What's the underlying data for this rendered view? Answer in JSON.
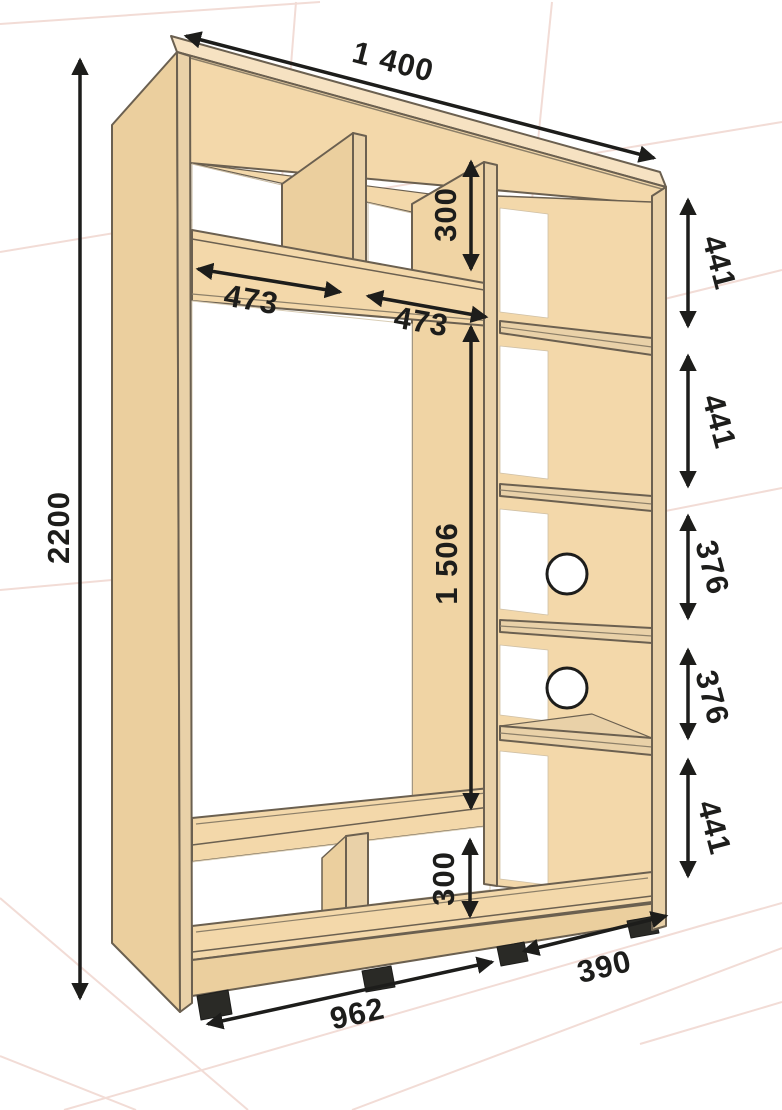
{
  "diagram": {
    "title": "Wardrobe carcass dimension drawing",
    "view": "perspective front view",
    "units": "mm",
    "colors": {
      "panel_face": "#f3d8aa",
      "panel_side": "#ebcf9e",
      "panel_edge": "#e9d1a8",
      "outline": "#6b6050",
      "dimension_ink": "#1d1d1b",
      "background": "#ffffff",
      "grid_line": "#f2dcd6"
    },
    "dimensions": {
      "overall_width": "1 400",
      "overall_height": "2200",
      "top_section_left_width": "473",
      "top_section_right_width": "473",
      "top_section_height": "300",
      "hanging_section_height": "1 506",
      "bottom_section_height": "300",
      "right_column_space_1": "441",
      "right_column_space_2": "441",
      "right_column_space_3": "376",
      "right_column_space_4": "376",
      "right_column_space_5": "441",
      "left_section_width": "962",
      "side_depth": "390"
    },
    "features": {
      "rod_holes_count": 2,
      "feet_count": 4,
      "right_column_shelves": 4
    }
  }
}
